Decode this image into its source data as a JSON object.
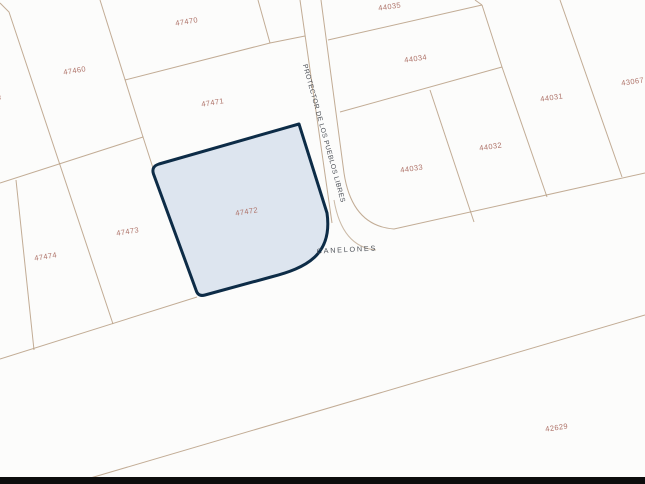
{
  "map": {
    "type": "cadastral-parcel-map",
    "background_color": "#fcfcfb",
    "parcel_line_color": "#b79e83",
    "parcel_label_color": "#ae7268",
    "street_label_color": "#4b4f56",
    "letterbox_bar_color": "#0d0d0d",
    "highlight": {
      "parcel_id": "47472",
      "fill_color": "#dde5ef",
      "border_color": "#0d2c47"
    },
    "parcels": [
      {
        "id": "47470"
      },
      {
        "id": "47460"
      },
      {
        "id": "47471"
      },
      {
        "id": "47472"
      },
      {
        "id": "47473"
      },
      {
        "id": "47474"
      },
      {
        "id": "8"
      },
      {
        "id": "44035"
      },
      {
        "id": "44034"
      },
      {
        "id": "44033"
      },
      {
        "id": "44032"
      },
      {
        "id": "44031"
      },
      {
        "id": "43067"
      },
      {
        "id": "42629"
      }
    ],
    "streets": [
      {
        "name": "PROTECTOR DE LOS PUEBLOS LIBRES"
      },
      {
        "name": "CANELONES"
      }
    ]
  }
}
